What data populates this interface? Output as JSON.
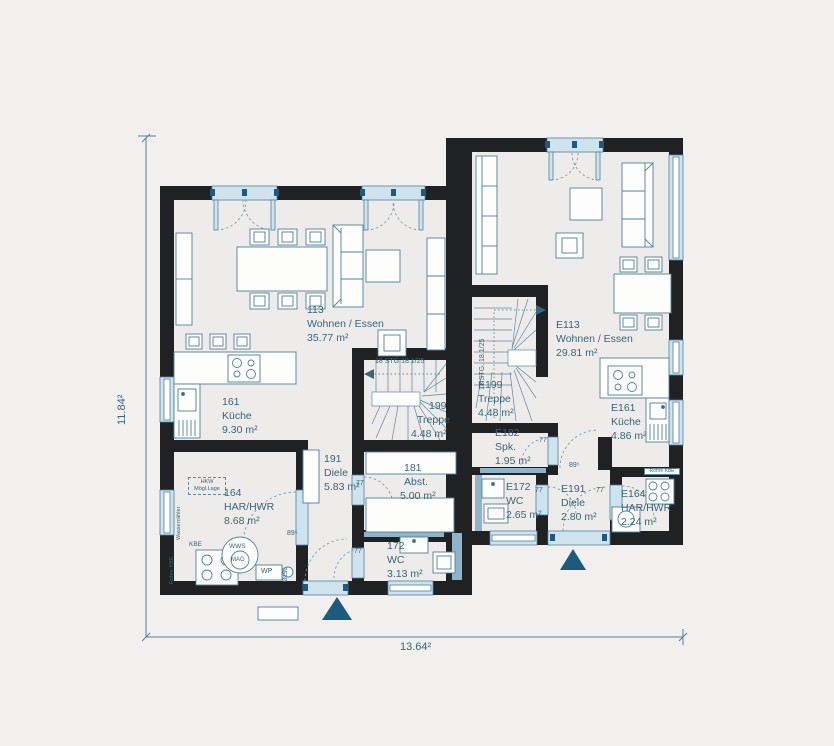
{
  "colors": {
    "background": "#f1f0ee",
    "floor": "#edecE9",
    "wall": "#202122",
    "line": "#52809c",
    "window": "#cfe3ef",
    "pipe": "#8fb3c9",
    "accent": "#1d5a7e",
    "text": "#3a6578"
  },
  "dimensions": {
    "height": "11.84²",
    "width": "13.64²"
  },
  "units": {
    "left": {
      "rooms": [
        {
          "number": "113",
          "name": "Wohnen / Essen",
          "area": "35.77 m²"
        },
        {
          "number": "161",
          "name": "Küche",
          "area": "9.30 m²"
        },
        {
          "number": "199",
          "name": "Treppe",
          "area": "4.48 m²"
        },
        {
          "number": "191",
          "name": "Diele",
          "area": "5.83 m²"
        },
        {
          "number": "181",
          "name": "Abst.",
          "area": "5.00 m²"
        },
        {
          "number": "164",
          "name": "HAR/HWR",
          "area": "8.68 m²"
        },
        {
          "number": "172",
          "name": "WC",
          "area": "3.13 m²"
        }
      ]
    },
    "right": {
      "rooms": [
        {
          "number": "E113",
          "name": "Wohnen / Essen",
          "area": "29.81 m²"
        },
        {
          "number": "E199",
          "name": "Treppe",
          "area": "4.48 m²"
        },
        {
          "number": "E182",
          "name": "Spk.",
          "area": "1.95 m²"
        },
        {
          "number": "E161",
          "name": "Küche",
          "area": "4.86 m²"
        },
        {
          "number": "E172",
          "name": "WC",
          "area": "2.65 m²"
        },
        {
          "number": "E191",
          "name": "Diele",
          "area": "2.80 m²"
        },
        {
          "number": "E164",
          "name": "HAR/HWR",
          "area": "2.24 m²"
        }
      ]
    }
  },
  "annotations": {
    "stg_left": "18 STG 18.1/25",
    "stg_right": "18 STG. 18.1/25",
    "hkw1": "HKW",
    "hkw2": "Mögl.Lage",
    "wasserzaehler": "Wasserzähler",
    "rohre_kbe": "Rohre KBE",
    "kbe": "KBE",
    "wws": "WWS",
    "mag": "MAG",
    "wp": "WP",
    "d150": "Ø150",
    "w89": "89⁵",
    "w77": "77"
  }
}
